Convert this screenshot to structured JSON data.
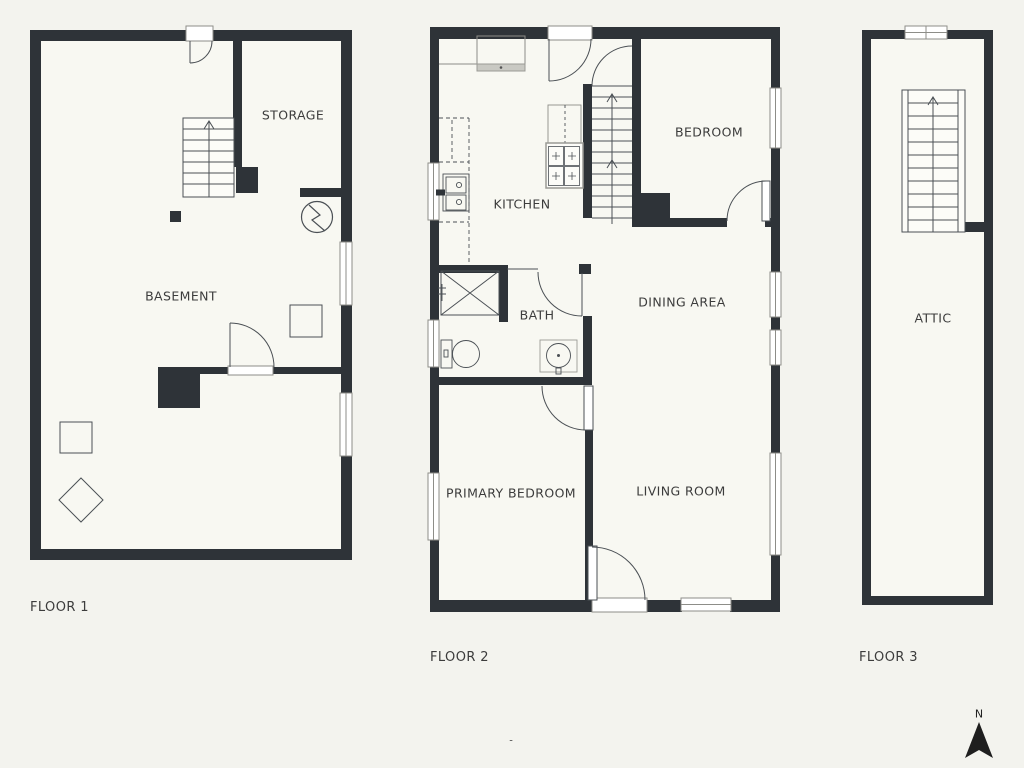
{
  "theme": {
    "background": "#f3f3ee",
    "room_fill": "#f8f8f2",
    "wall_color": "#2e3338",
    "line_color": "#4b5055",
    "light_line_color": "#8d8d88",
    "text_color": "#3c3c3c"
  },
  "floors": [
    {
      "label": "FLOOR 1",
      "rooms": [
        {
          "name": "STORAGE"
        },
        {
          "name": "BASEMENT"
        }
      ]
    },
    {
      "label": "FLOOR 2",
      "rooms": [
        {
          "name": "KITCHEN"
        },
        {
          "name": "BEDROOM"
        },
        {
          "name": "BATH"
        },
        {
          "name": "DINING AREA"
        },
        {
          "name": "PRIMARY BEDROOM"
        },
        {
          "name": "LIVING ROOM"
        }
      ]
    },
    {
      "label": "FLOOR 3",
      "rooms": [
        {
          "name": "ATTIC"
        }
      ]
    }
  ],
  "compass": {
    "label": "N"
  },
  "page_dash": "-"
}
